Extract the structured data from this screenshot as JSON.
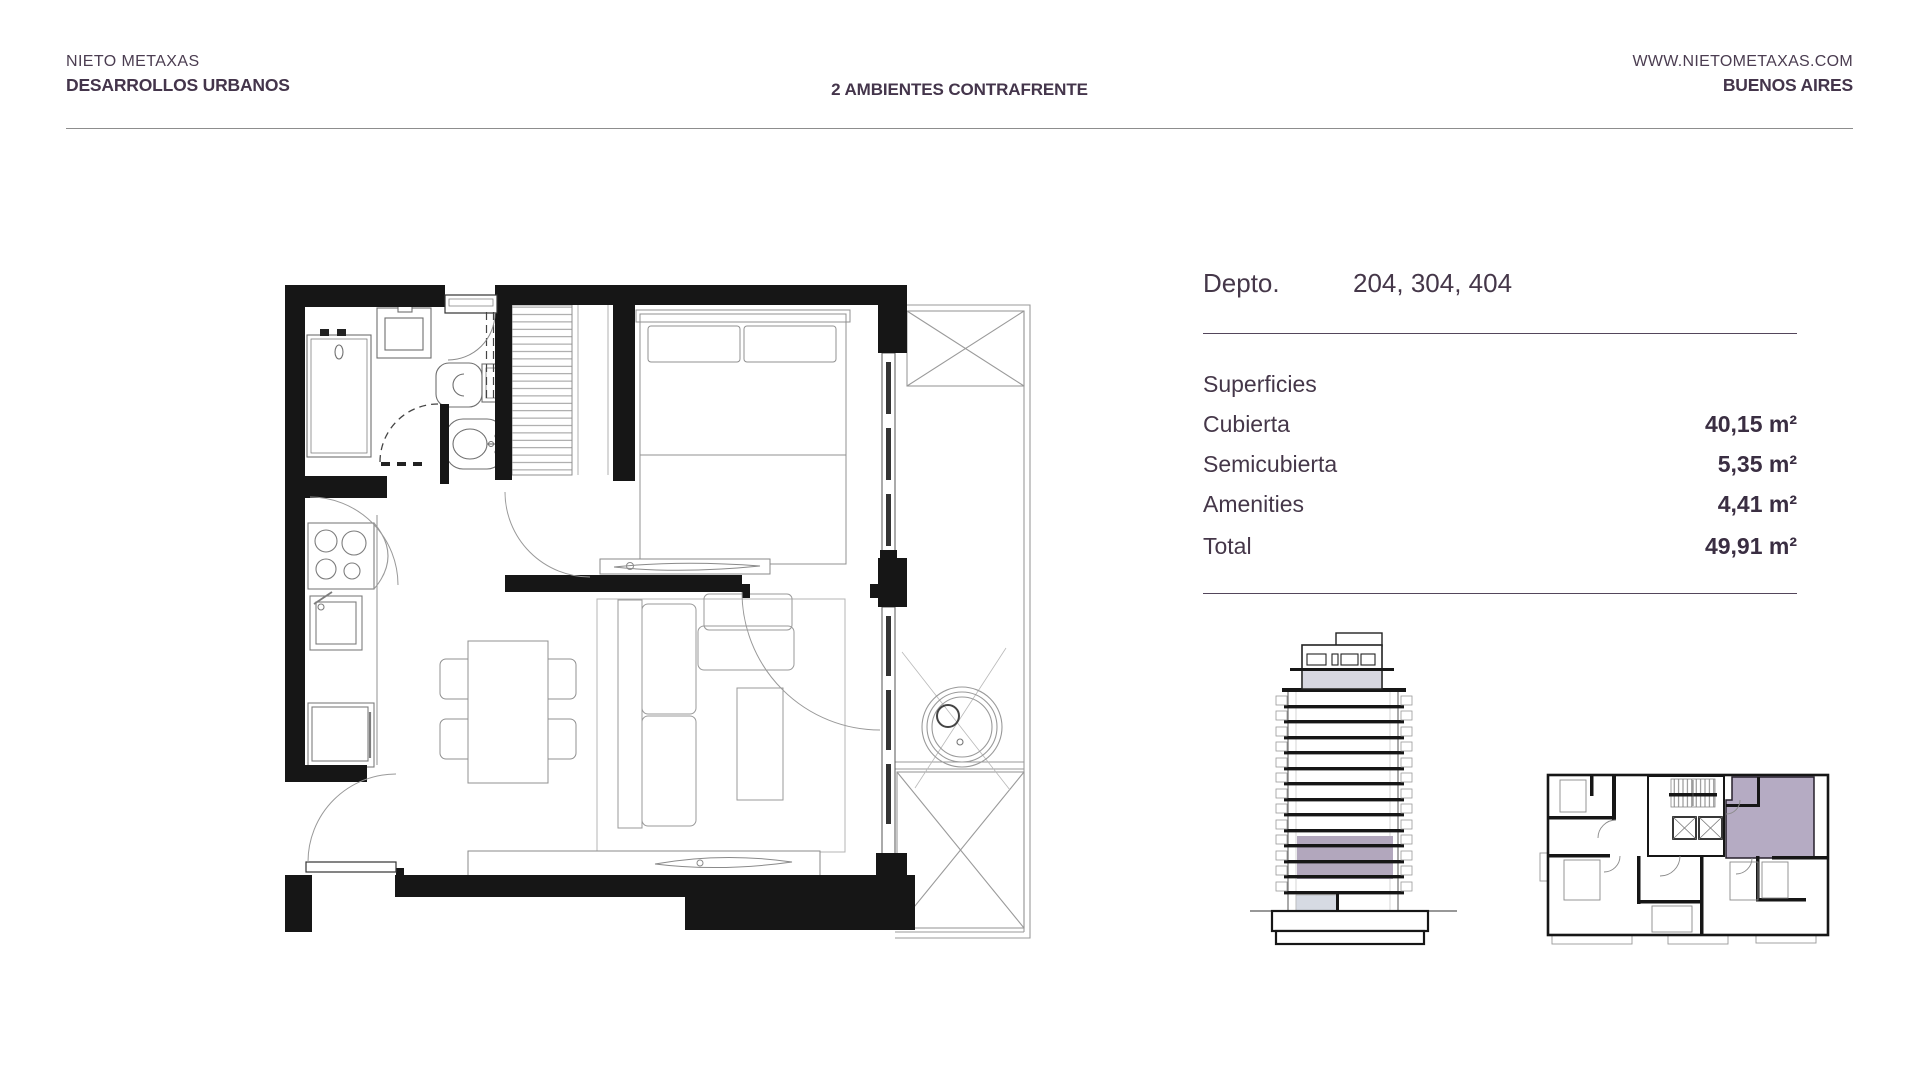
{
  "header": {
    "brand_line1": "NIETO METAXAS",
    "brand_line2": "DESARROLLOS URBANOS",
    "page_title": "2 AMBIENTES CONTRAFRENTE",
    "website": "WWW.NIETOMETAXAS.COM",
    "city": "BUENOS AIRES"
  },
  "unit_info": {
    "depto_label": "Depto.",
    "depto_numbers": "204, 304, 404",
    "section_title": "Superficies",
    "rows": [
      {
        "label": "Cubierta",
        "value": "40,15 m²"
      },
      {
        "label": "Semicubierta",
        "value": "5,35 m²"
      },
      {
        "label": "Amenities",
        "value": "4,41 m²"
      },
      {
        "label": "Total",
        "value": "49,91 m²"
      }
    ]
  },
  "colors": {
    "text": "#44354b",
    "wall_black": "#161616",
    "highlight_purple": "#b2a7bd",
    "keyplan_purple": "#ada2bd",
    "entrance_gray": "#d6dae3",
    "rule_gray": "#8d8d8d"
  }
}
